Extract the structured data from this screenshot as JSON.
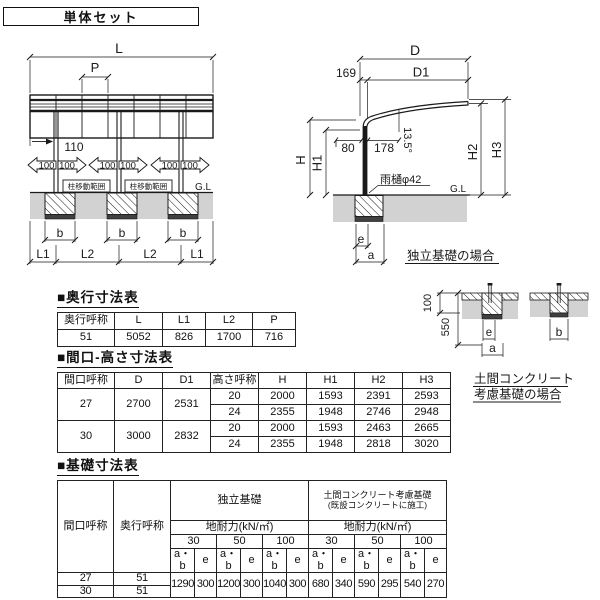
{
  "page": {
    "title": "単体セット"
  },
  "front_view": {
    "dim_l": "L",
    "dim_p": "P",
    "dim_110": "110",
    "movement_value": "100",
    "movement_range": "柱移動範囲",
    "ground_line": "G.L",
    "dim_b": "b",
    "dim_l1": "L1",
    "dim_l2": "L2"
  },
  "side_view": {
    "dim_d": "D",
    "dim_d1": "D1",
    "dim_169": "169",
    "dim_80": "80",
    "dim_178": "178",
    "roof_angle": "13.5°",
    "gutter": "雨樋φ42",
    "ground_line": "G.L",
    "dim_h": "H",
    "dim_h1": "H1",
    "dim_h2": "H2",
    "dim_h3": "H3",
    "dim_e": "e",
    "dim_a": "a",
    "caption": "独立基礎の場合"
  },
  "foundation_detail": {
    "dim_100": "100",
    "dim_550": "550",
    "dim_e": "e",
    "dim_a": "a",
    "dim_b": "b",
    "caption_line1": "土間コンクリート",
    "caption_line2": "考慮基礎の場合"
  },
  "tables": {
    "depth": {
      "title": "■奥行寸法表",
      "headers": [
        "奥行呼称",
        "L",
        "L1",
        "L2",
        "P"
      ],
      "rows": [
        [
          "51",
          "5052",
          "826",
          "1700",
          "716"
        ]
      ]
    },
    "size": {
      "title": "■間口-高さ寸法表",
      "headers": [
        "間口呼称",
        "D",
        "D1",
        "高さ呼称",
        "H",
        "H1",
        "H2",
        "H3"
      ],
      "rows": [
        [
          "27",
          "2700",
          "2531",
          "20",
          "2000",
          "1593",
          "2391",
          "2593"
        ],
        [
          "24",
          "2355",
          "1948",
          "2746",
          "2948"
        ],
        [
          "30",
          "3000",
          "2832",
          "20",
          "2000",
          "1593",
          "2463",
          "2665"
        ],
        [
          "24",
          "2355",
          "1948",
          "2818",
          "3020"
        ]
      ]
    },
    "foundation": {
      "title": "■基礎寸法表",
      "col_opening": "間口呼称",
      "col_depth": "奥行呼称",
      "group_independent": "独立基礎",
      "group_slab_line1": "土間コンクリート考慮基礎",
      "group_slab_line2": "(既設コンクリートに施工)",
      "bearing_capacity": "地耐力(kN/㎡)",
      "loads": [
        "30",
        "50",
        "100"
      ],
      "sub_ab": "a・b",
      "sub_e": "e",
      "rows": [
        [
          "27",
          "51"
        ],
        [
          "30",
          "51"
        ]
      ],
      "values": [
        "1290",
        "300",
        "1200",
        "300",
        "1040",
        "300",
        "680",
        "340",
        "590",
        "295",
        "540",
        "270"
      ]
    }
  },
  "colors": {
    "accent": "#e4007f",
    "ground": "#d2d2d2"
  }
}
